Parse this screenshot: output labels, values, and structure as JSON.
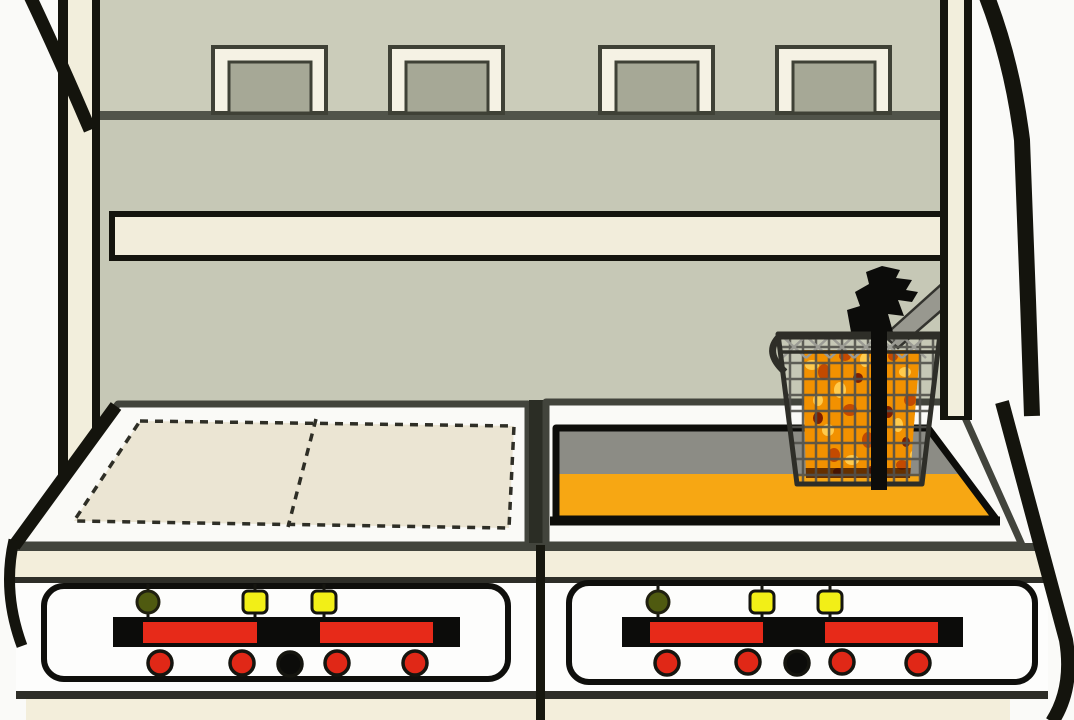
{
  "scene": {
    "vent_count": 4,
    "left_counter_trays": 2,
    "right_counter": "fryer-vat",
    "basket_contents": "fries"
  },
  "colors": {
    "background": "#fafaf8",
    "outline": "#14140d",
    "wall_upper": "#cbccba",
    "wall_lower": "#c6c8b6",
    "wall_ledge": "#51544a",
    "vent_frame": "#f5f2e4",
    "vent_inner": "#a6a896",
    "rail": "#f2eddb",
    "pillar": "#f2eedc",
    "counter_surface": "#fafaf7",
    "counter_edge": "#42443c",
    "tray": "#ebe5d3",
    "tray_outline": "#2e2e26",
    "vat_wall": "#8c8c85",
    "oil": "#f7a713",
    "vat_outline": "#0d0d0a",
    "front_band": "#f3eedb",
    "band_line": "#2e2e28",
    "panel_face": "#fdfdfc",
    "panel_outline": "#0f0f0c",
    "track": "#0c0c0a",
    "light_stem": "#15150f",
    "basket_wire": "#52524c",
    "basket_wire_light": "#9b9b94",
    "basket_frame": "#2e2e28",
    "handle": "#0c0c0a",
    "hanger_plate": "#98988f",
    "fries_base": "#f29100",
    "fries_light": "#ffcb4e",
    "fries_dark": "#c34a00",
    "fries_burnt": "#7e1f00",
    "fries_shadow": "#351000"
  },
  "panels": [
    {
      "side": "left",
      "lights": [
        {
          "name": "indicator-1",
          "state": "off",
          "color": "#4f5a10"
        },
        {
          "name": "indicator-2",
          "state": "on",
          "color": "#f2ef17"
        },
        {
          "name": "indicator-3",
          "state": "on",
          "color": "#f2ef17"
        }
      ],
      "sliders": [
        {
          "name": "slider-1",
          "color": "#e72a19"
        },
        {
          "name": "slider-2",
          "color": "#e72a19"
        }
      ],
      "buttons": [
        {
          "name": "button-1",
          "color": "#e02817"
        },
        {
          "name": "button-2",
          "color": "#e02817"
        },
        {
          "name": "button-3",
          "color": "#0c0c0a"
        },
        {
          "name": "button-4",
          "color": "#e02817"
        },
        {
          "name": "button-5",
          "color": "#e02817"
        }
      ]
    },
    {
      "side": "right",
      "lights": [
        {
          "name": "indicator-1",
          "state": "off",
          "color": "#4f5a10"
        },
        {
          "name": "indicator-2",
          "state": "on",
          "color": "#f2ef17"
        },
        {
          "name": "indicator-3",
          "state": "on",
          "color": "#f2ef17"
        }
      ],
      "sliders": [
        {
          "name": "slider-1",
          "color": "#e72a19"
        },
        {
          "name": "slider-2",
          "color": "#e72a19"
        }
      ],
      "buttons": [
        {
          "name": "button-1",
          "color": "#e02817"
        },
        {
          "name": "button-2",
          "color": "#e02817"
        },
        {
          "name": "button-3",
          "color": "#0c0c0a"
        },
        {
          "name": "button-4",
          "color": "#e02817"
        },
        {
          "name": "button-5",
          "color": "#e02817"
        }
      ]
    }
  ]
}
